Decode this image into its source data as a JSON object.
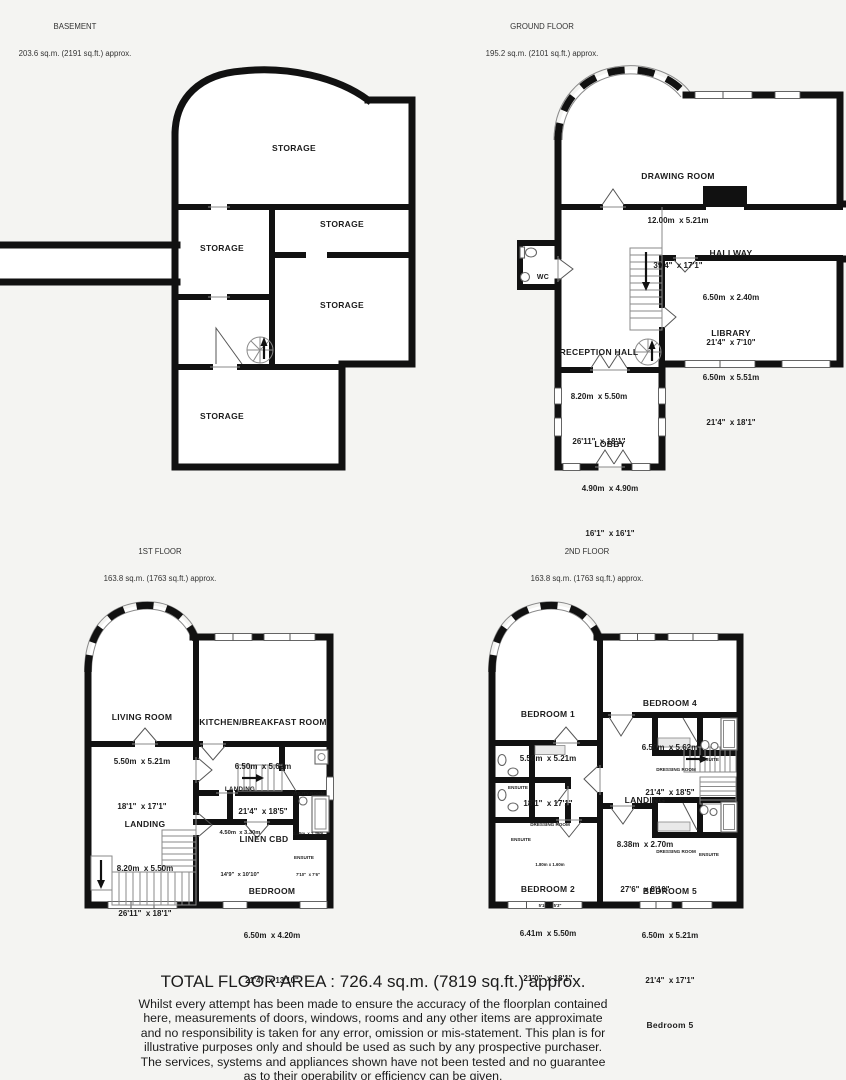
{
  "palette": {
    "background": "#f4f4f2",
    "wall": "#111111",
    "room_fill": "#ffffff"
  },
  "floors": {
    "basement": {
      "title": "BASEMENT",
      "area": "203.6 sq.m. (2191 sq.ft.) approx.",
      "storage": "STORAGE"
    },
    "ground": {
      "title": "GROUND FLOOR",
      "area": "195.2 sq.m. (2101 sq.ft.) approx.",
      "drawing_room": {
        "name": "DRAWING ROOM",
        "metric": "12.00m  x 5.21m",
        "imperial": "39'4\"  x 17'1\""
      },
      "hallway": {
        "name": "HALLWAY",
        "metric": "6.50m  x 2.40m",
        "imperial": "21'4\"  x 7'10\""
      },
      "reception_hall": {
        "name": "RECEPTION HALL",
        "metric": "8.20m  x 5.50m",
        "imperial": "26'11\"  x 18'1\""
      },
      "library": {
        "name": "LIBRARY",
        "metric": "6.50m  x 5.51m",
        "imperial": "21'4\"  x 18'1\""
      },
      "lobby": {
        "name": "LOBBY",
        "metric": "4.90m  x 4.90m",
        "imperial": "16'1\"  x 16'1\""
      },
      "wc": "WC"
    },
    "first": {
      "title": "1ST FLOOR",
      "area": "163.8 sq.m. (1763 sq.ft.) approx.",
      "living_room": {
        "name": "LIVING ROOM",
        "metric": "5.50m  x 5.21m",
        "imperial": "18'1\"  x 17'1\""
      },
      "kitchen": {
        "name": "KITCHEN/BREAKFAST ROOM",
        "metric": "6.50m  x 5.62m",
        "imperial": "21'4\"  x 18'5\""
      },
      "landing": {
        "name": "LANDING",
        "metric": "8.20m  x 5.50m",
        "imperial": "26'11\"  x 18'1\""
      },
      "landing_small": {
        "name": "LANDING",
        "metric": "4.50m  x 3.30m",
        "imperial": "14'9\"  x 10'10\""
      },
      "utility": {
        "name": "UTILITY ROOM",
        "metric": "2.40m  x 2.29m",
        "imperial": "7'10\"  x 7'6\""
      },
      "linen": "LINEN CBD",
      "ensuite": "ENSUITE",
      "bedroom": {
        "name": "BEDROOM",
        "metric": "6.50m  x 4.20m",
        "imperial": "21'4\"  x 13'10\""
      }
    },
    "second": {
      "title": "2ND FLOOR",
      "area": "163.8 sq.m. (1763 sq.ft.) approx.",
      "bedroom1": {
        "name": "BEDROOM 1",
        "metric": "5.50m  x 5.21m",
        "imperial": "18'1\"  x 17'1\""
      },
      "bedroom4": {
        "name": "BEDROOM 4",
        "metric": "6.50m  x 5.62m",
        "imperial": "21'4\"  x 18'5\""
      },
      "landing": {
        "name": "LANDING",
        "metric": "8.38m  x 2.70m",
        "imperial": "27'6\"  x 8'10\""
      },
      "bedroom2": {
        "name": "BEDROOM 2",
        "metric": "6.41m  x 5.50m",
        "imperial": "21'0\"  x 18'1\""
      },
      "bedroom5": {
        "name": "BEDROOM 5",
        "metric": "6.50m  x 5.21m",
        "imperial": "21'4\"  x 17'1\"",
        "extra": "Bedroom 5"
      },
      "dressing": "DRESSING ROOM",
      "dressing_left": {
        "name": "DRESSING ROOM",
        "metric": "1.80m x 1.60m",
        "imperial": "5'10\" x 5'3\""
      },
      "ensuite": "ENSUITE"
    }
  },
  "footer": {
    "total": "TOTAL FLOOR AREA : 726.4 sq.m. (7819 sq.ft.) approx.",
    "disclaimer": "Whilst every attempt has been made to ensure the accuracy of the floorplan contained here, measurements of doors, windows, rooms and any other items are approximate and no responsibility is taken for any error, omission or mis-statement. This plan is for illustrative purposes only and should be used as such by any prospective purchaser. The services, systems and appliances shown have not been tested and no guarantee as to their operability or efficiency can be given.",
    "credit": "Made with Metropix ©2024"
  }
}
